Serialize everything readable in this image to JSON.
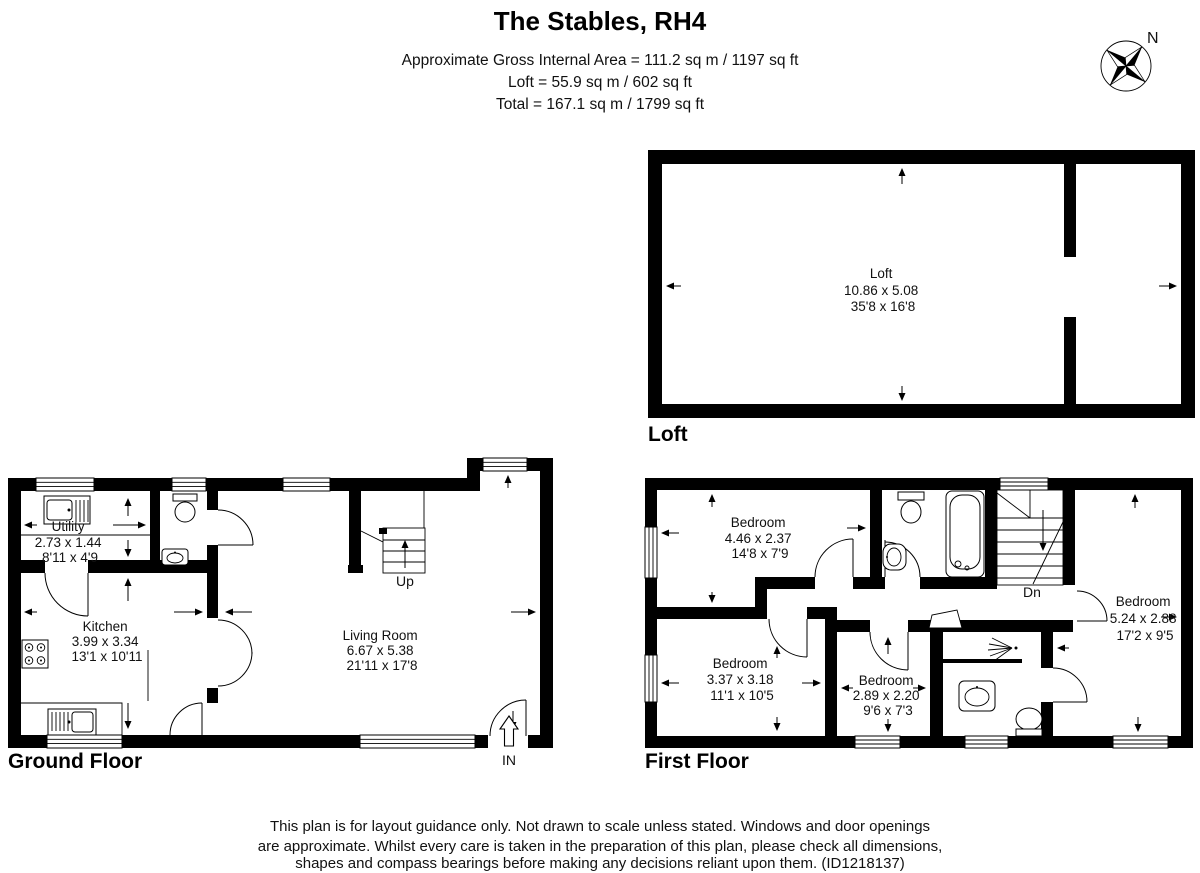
{
  "header": {
    "title": "The Stables, RH4",
    "area_line1": "Approximate Gross Internal Area = 111.2 sq m / 1197 sq ft",
    "area_line2": "Loft = 55.9 sq m / 602 sq ft",
    "area_line3": "Total = 167.1 sq m / 1799 sq ft"
  },
  "compass": {
    "north_label": "N"
  },
  "floors": {
    "loft": {
      "label": "Loft",
      "rooms": [
        {
          "name": "Loft",
          "metric": "10.86 x 5.08",
          "imperial": "35'8 x 16'8"
        }
      ]
    },
    "ground": {
      "label": "Ground Floor",
      "stairs_label": "Up",
      "entrance_label": "IN",
      "rooms": [
        {
          "name": "Utility",
          "metric": "2.73 x 1.44",
          "imperial": "8'11 x 4'9"
        },
        {
          "name": "Kitchen",
          "metric": "3.99 x 3.34",
          "imperial": "13'1 x 10'11"
        },
        {
          "name": "Living Room",
          "metric": "6.67 x 5.38",
          "imperial": "21'11 x 17'8"
        }
      ],
      "fixtures": [
        "utility-sink",
        "wc-toilet",
        "wc-basin",
        "kitchen-hob",
        "kitchen-sink"
      ]
    },
    "first": {
      "label": "First Floor",
      "stairs_label": "Dn",
      "rooms": [
        {
          "name": "Bedroom",
          "metric": "4.46 x 2.37",
          "imperial": "14'8 x 7'9"
        },
        {
          "name": "Bedroom",
          "metric": "3.37 x 3.18",
          "imperial": "11'1 x 10'5"
        },
        {
          "name": "Bedroom",
          "metric": "2.89 x 2.20",
          "imperial": "9'6 x 7'3"
        },
        {
          "name": "Bedroom",
          "metric": "5.24 x 2.88",
          "imperial": "17'2 x 9'5"
        }
      ],
      "fixtures": [
        "bathroom-toilet",
        "bathroom-basin",
        "bathtub",
        "shower",
        "shower-room-basin",
        "shower-room-toilet"
      ]
    }
  },
  "footer": {
    "line1": "This plan is for layout guidance only. Not drawn to scale unless stated. Windows and door openings",
    "line2": "are approximate. Whilst every care is taken in the preparation of this plan, please check all dimensions,",
    "line3": "shapes and compass bearings before making any decisions reliant upon them. (ID1218137)"
  },
  "colors": {
    "wall": "#000000",
    "background": "#ffffff",
    "text": "#111111"
  }
}
